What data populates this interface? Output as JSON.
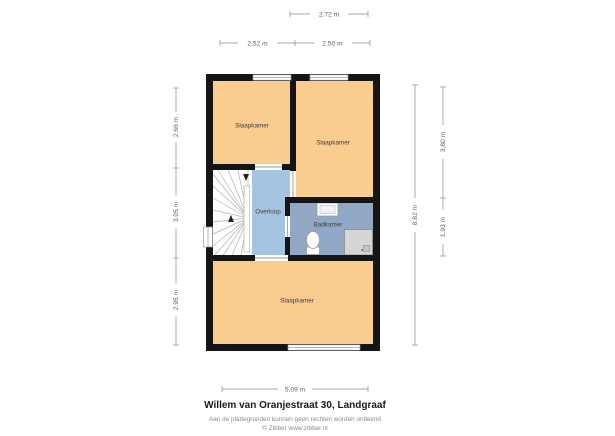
{
  "meta": {
    "title": "Willem van Oranjestraat 30, Landgraaf",
    "disclaimer": "Aan de plattegronden kunnen geen rechten worden ontleend",
    "copyright": "© Zibber www.zibber.nl"
  },
  "rooms": {
    "bedroom_top_left": "Slaapkamer",
    "bedroom_top_right": "Slaapkamer",
    "landing": "Overloop",
    "bathroom": "Badkamer",
    "bedroom_bottom": "Slaapkamer"
  },
  "dimensions": {
    "top_total": "2.72 m",
    "top_left": "2.52 m",
    "top_right": "2.50 m",
    "left_top": "2.66 m",
    "left_middle": "3.05 m",
    "left_bottom": "2.95 m",
    "right_total": "8.82 m",
    "right_top": "3.80 m",
    "right_bottom": "1.93 m",
    "bottom_width": "5.09 m"
  },
  "colors": {
    "room_fill": "#f9cc8f",
    "landing_fill": "#a7c3e2",
    "bathroom_fill": "#90a7c6",
    "wall": "#151515",
    "shower_fill": "#d6d6d6",
    "dimension_line": "#8a8a8a"
  }
}
